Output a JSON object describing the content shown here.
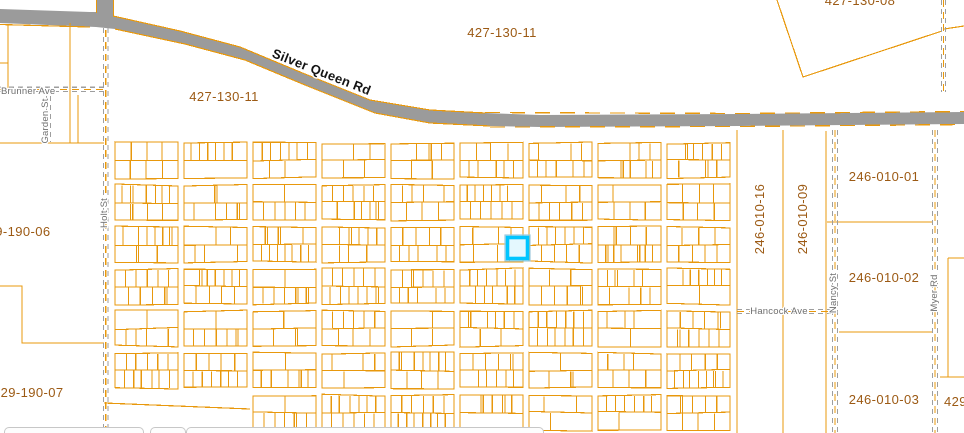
{
  "map": {
    "colors": {
      "parcel_line": "#E8980C",
      "label_brown": "#9C5A14",
      "street_gray": "#6E6E6E",
      "road_fill": "#9B9B9B",
      "dash_gray": "#9E9E9E",
      "highlight_stroke": "#00C5FF",
      "highlight_fill": "#E4F8FE",
      "highlight_halo": "#9EC9DC"
    },
    "road_label": {
      "text": "Silver Queen Rd",
      "x": 320,
      "y": 76,
      "rot": 21.5
    },
    "parcel_labels": [
      {
        "text": "427-130-11",
        "x": 502,
        "y": 37,
        "rot": 0
      },
      {
        "text": "427-130-11",
        "x": 224,
        "y": 101,
        "rot": 0
      },
      {
        "text": "427-130-08",
        "x": 860,
        "y": 5,
        "rot": 0
      },
      {
        "text": "429-190-06",
        "x": -20,
        "y": 236,
        "rot": 0,
        "anchor": "start"
      },
      {
        "text": "429-190-07",
        "x": -7,
        "y": 397,
        "rot": 0,
        "anchor": "start"
      },
      {
        "text": "246-010-01",
        "x": 884,
        "y": 181,
        "rot": 0
      },
      {
        "text": "246-010-16",
        "x": 764,
        "y": 219,
        "rot": -90
      },
      {
        "text": "246-010-09",
        "x": 807,
        "y": 219,
        "rot": -90
      },
      {
        "text": "246-010-02",
        "x": 884,
        "y": 282,
        "rot": 0
      },
      {
        "text": "246-010-03",
        "x": 884,
        "y": 404,
        "rot": 0
      },
      {
        "text": "429",
        "x": 944,
        "y": 406,
        "rot": 0,
        "anchor": "start"
      }
    ],
    "street_labels": [
      {
        "text": "Brunner Ave",
        "x": 1,
        "y": 94,
        "rot": 0,
        "anchor": "start"
      },
      {
        "text": "Garden St",
        "x": 48,
        "y": 121,
        "rot": -90
      },
      {
        "text": "Holt St",
        "x": 107,
        "y": 213,
        "rot": -90
      },
      {
        "text": "Hancock Ave",
        "x": 779,
        "y": 314,
        "rot": 0
      },
      {
        "text": "Nancy St",
        "x": 836,
        "y": 293,
        "rot": -90
      },
      {
        "text": "Myer Rd",
        "x": 937,
        "y": 293,
        "rot": -90
      }
    ],
    "highlight": {
      "x": 507.5,
      "y": 237.5,
      "w": 20,
      "h": 21
    },
    "grid": {
      "x0": 115,
      "col_pitch": 69,
      "col_width": 63,
      "cols": 9,
      "y0": 143,
      "row_pitch": 42,
      "row_height": 35,
      "rows": 7,
      "skip_blocks": [
        [
          0,
          6
        ],
        [
          1,
          6
        ]
      ],
      "seed": 7
    }
  }
}
